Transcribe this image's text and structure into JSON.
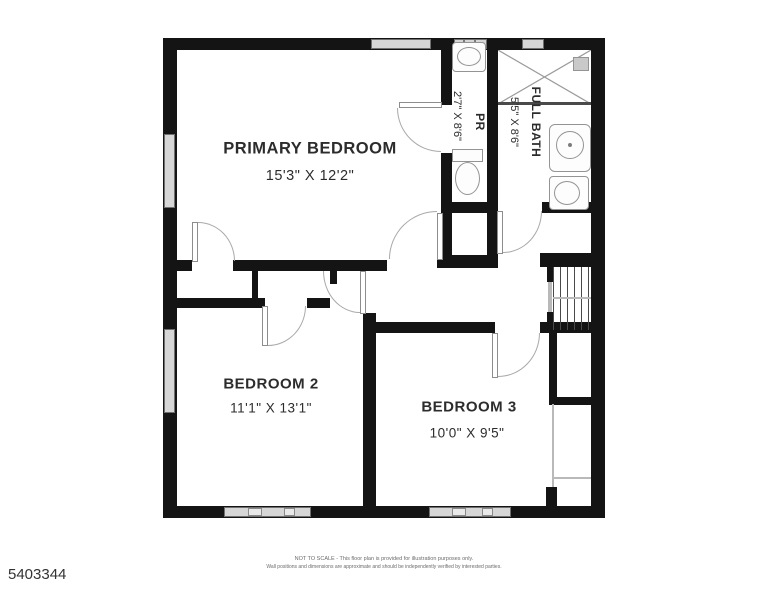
{
  "page": {
    "mls_number": "5403344",
    "disclaimer_line1": "NOT TO SCALE - This floor plan is provided for illustration purposes only.",
    "disclaimer_line2": "Wall positions and dimensions are approximate and should be independently verified by interested parties."
  },
  "floorplan": {
    "rooms": [
      {
        "id": "primary-bedroom",
        "name": "PRIMARY BEDROOM",
        "dims": "15'3\" X 12'2\""
      },
      {
        "id": "bedroom-2",
        "name": "BEDROOM 2",
        "dims": "11'1\" X 13'1\""
      },
      {
        "id": "bedroom-3",
        "name": "BEDROOM 3",
        "dims": "10'0\" X 9'5\""
      },
      {
        "id": "powder-room",
        "name": "PR",
        "dims": "2'7\" X 8'6\""
      },
      {
        "id": "full-bath",
        "name": "FULL BATH",
        "dims": "5'5\" X 8'6\""
      }
    ]
  }
}
